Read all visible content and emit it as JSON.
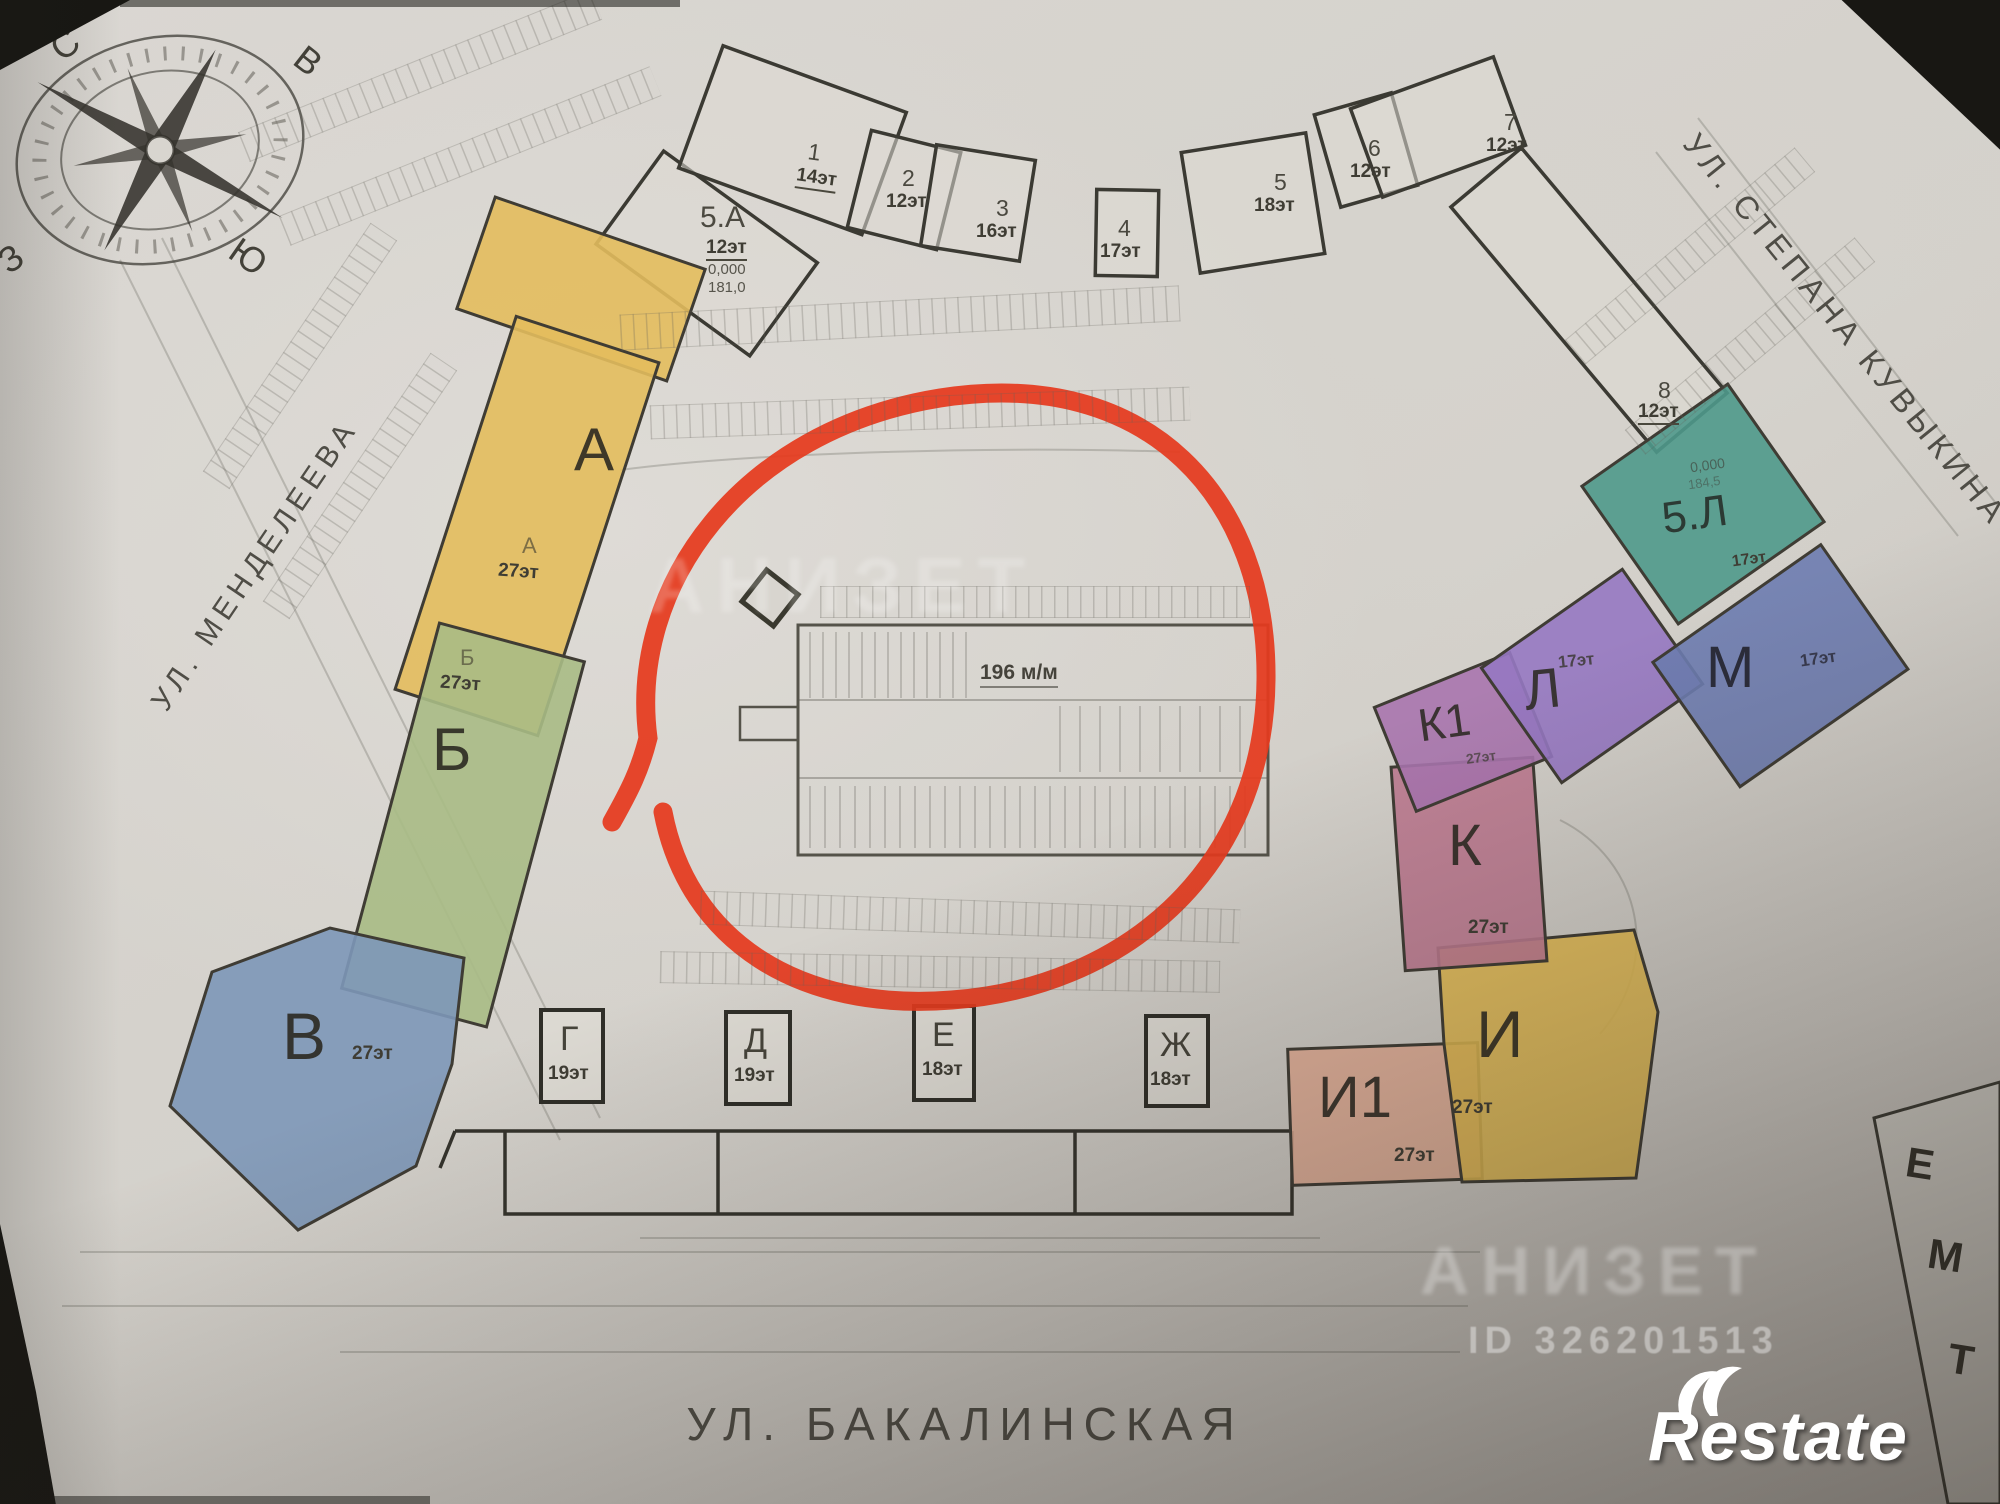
{
  "plan": {
    "compass": {
      "n": "С",
      "e": "В",
      "s": "Ю",
      "w": "З"
    },
    "streets": {
      "left": "УЛ. МЕНДЕЛЕЕВА",
      "right": "УЛ. СТЕПАНА КУВЫКИНА",
      "bottom": "УЛ. БАКАЛИНСКАЯ"
    },
    "parking": {
      "capacity": "196 м/м"
    },
    "buildings": {
      "b1": {
        "num": "1",
        "floors": "14эт"
      },
      "b2": {
        "num": "2",
        "floors": "12эт"
      },
      "b3": {
        "num": "3",
        "floors": "16эт"
      },
      "b4": {
        "num": "4",
        "floors": "17эт"
      },
      "b5": {
        "num": "5",
        "floors": "18эт"
      },
      "b6": {
        "num": "6",
        "floors": "12эт"
      },
      "b7": {
        "num": "7",
        "floors": "12эт"
      },
      "b8": {
        "num": "8",
        "floors": "12эт"
      },
      "b5a": {
        "name": "5.А",
        "floors": "12эт",
        "elev": "0,000",
        "mark": "181,0"
      },
      "b5l": {
        "name": "5.Л",
        "floors": "17эт",
        "elev": "0,000",
        "mark": "184,5"
      },
      "a": {
        "letter": "А",
        "floors": "27эт",
        "color": "#e3bd5d"
      },
      "b": {
        "letter": "Б",
        "floors": "27эт",
        "color": "#a9bb85"
      },
      "v": {
        "letter": "В",
        "floors": "27эт",
        "color": "#7d97b8"
      },
      "g": {
        "letter": "Г",
        "floors": "19эт"
      },
      "d": {
        "letter": "Д",
        "floors": "19эт"
      },
      "e": {
        "letter": "Е",
        "floors": "18эт"
      },
      "zh": {
        "letter": "Ж",
        "floors": "18эт"
      },
      "i": {
        "letter": "И",
        "floors": "27эт",
        "color": "#e0b952"
      },
      "i1": {
        "letter": "И1",
        "floors": "27эт",
        "color": "#e2ae96"
      },
      "k": {
        "letter": "К",
        "floors": "27эт",
        "color": "#bd7a90"
      },
      "k1": {
        "letter": "К1",
        "floors": "27эт",
        "color": "#a874ae"
      },
      "l": {
        "letter": "Л",
        "floors": "17эт",
        "color": "#9678c2"
      },
      "m": {
        "letter": "М",
        "floors": "17эт",
        "color": "#6d7cb0"
      }
    },
    "legend": {
      "rows": [
        "Е",
        "М",
        "Т"
      ]
    },
    "annotation": {
      "red_circle_color": "#e53a1e"
    },
    "watermark": {
      "brand": "Restate",
      "id_text": "ID 326201513",
      "ghost": "АНИЗЕТ"
    }
  }
}
